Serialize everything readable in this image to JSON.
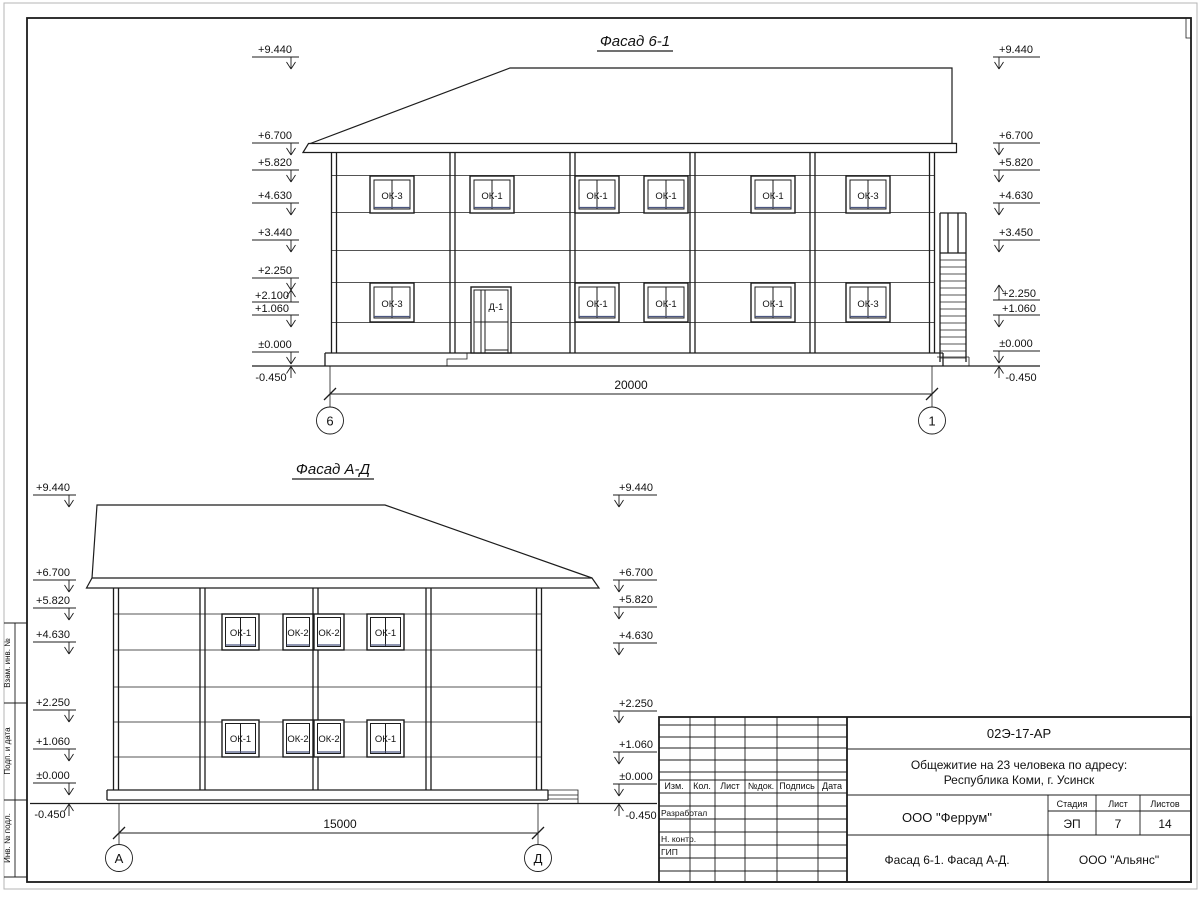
{
  "frame": {
    "stamp_vert_labels": [
      "Взам. инв. №",
      "Подп. и дата",
      "Инв. № подл."
    ]
  },
  "fasad61": {
    "title": "Фасад 6-1",
    "marks_left": [
      "+9.440",
      "+6.700",
      "+5.820",
      "+4.630",
      "+3.440",
      "+2.250",
      "+2.100",
      "+1.060",
      "±0.000",
      "-0.450"
    ],
    "marks_right": [
      "+9.440",
      "+6.700",
      "+5.820",
      "+4.630",
      "+3.450",
      "+2.250",
      "+1.060",
      "±0.000",
      "-0.450"
    ],
    "win_top": [
      "ОК-3",
      "ОК-1",
      "ОК-1",
      "ОК-1",
      "ОК-1",
      "ОК-3"
    ],
    "win_bottom": [
      "ОК-3",
      "ОК-1",
      "ОК-1",
      "ОК-1",
      "ОК-3"
    ],
    "door": "Д-1",
    "dim": "20000",
    "axis_l": "6",
    "axis_r": "1"
  },
  "fasadAD": {
    "title": "Фасад А-Д",
    "marks_left": [
      "+9.440",
      "+6.700",
      "+5.820",
      "+4.630",
      "+2.250",
      "+1.060",
      "±0.000",
      "-0.450"
    ],
    "marks_right": [
      "+9.440",
      "+6.700",
      "+5.820",
      "+4.630",
      "+2.250",
      "+1.060",
      "±0.000",
      "-0.450"
    ],
    "win_top": [
      "ОК-1",
      "ОК-2",
      "ОК-2",
      "ОК-1"
    ],
    "win_bottom": [
      "ОК-1",
      "ОК-2",
      "ОК-2",
      "ОК-1"
    ],
    "dim": "15000",
    "axis_l": "А",
    "axis_r": "Д"
  },
  "titleblock": {
    "doc_number": "02Э-17-АР",
    "project_line1": "Общежитие на 23 человека по адресу:",
    "project_line2": "Республика Коми, г. Усинск",
    "org": "ООО \"Феррум\"",
    "contractor": "ООО \"Альянс\"",
    "sheet_title": "Фасад 6-1. Фасад  А-Д.",
    "stage_label": "Стадия",
    "sheet_label": "Лист",
    "sheets_label": "Листов",
    "stage": "ЭП",
    "sheet": "7",
    "sheets": "14",
    "cols": [
      "Изм.",
      "Кол.",
      "Лист",
      "№док.",
      "Подпись",
      "Дата"
    ],
    "rows": [
      "Разработал",
      "Н. контр.",
      "ГИП"
    ]
  }
}
